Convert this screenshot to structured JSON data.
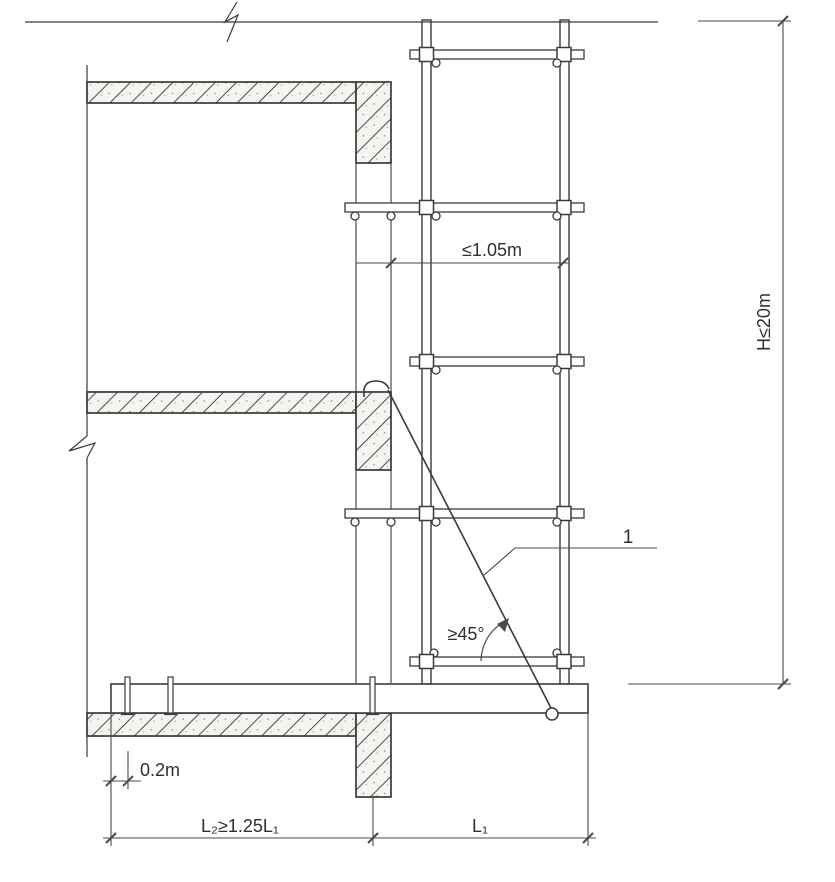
{
  "drawing": {
    "background": "#ffffff",
    "line_color": "#3a3a3a",
    "labels": {
      "scaffold_to_wall_gap": "≤1.05m",
      "total_height": "H≤20m",
      "brace_item_number": "1",
      "brace_angle": "≥45°",
      "anchor_edge_offset": "0.2m",
      "anchorage_length": "L₂≥1.25L₁",
      "cantilever_length": "L₁"
    }
  }
}
